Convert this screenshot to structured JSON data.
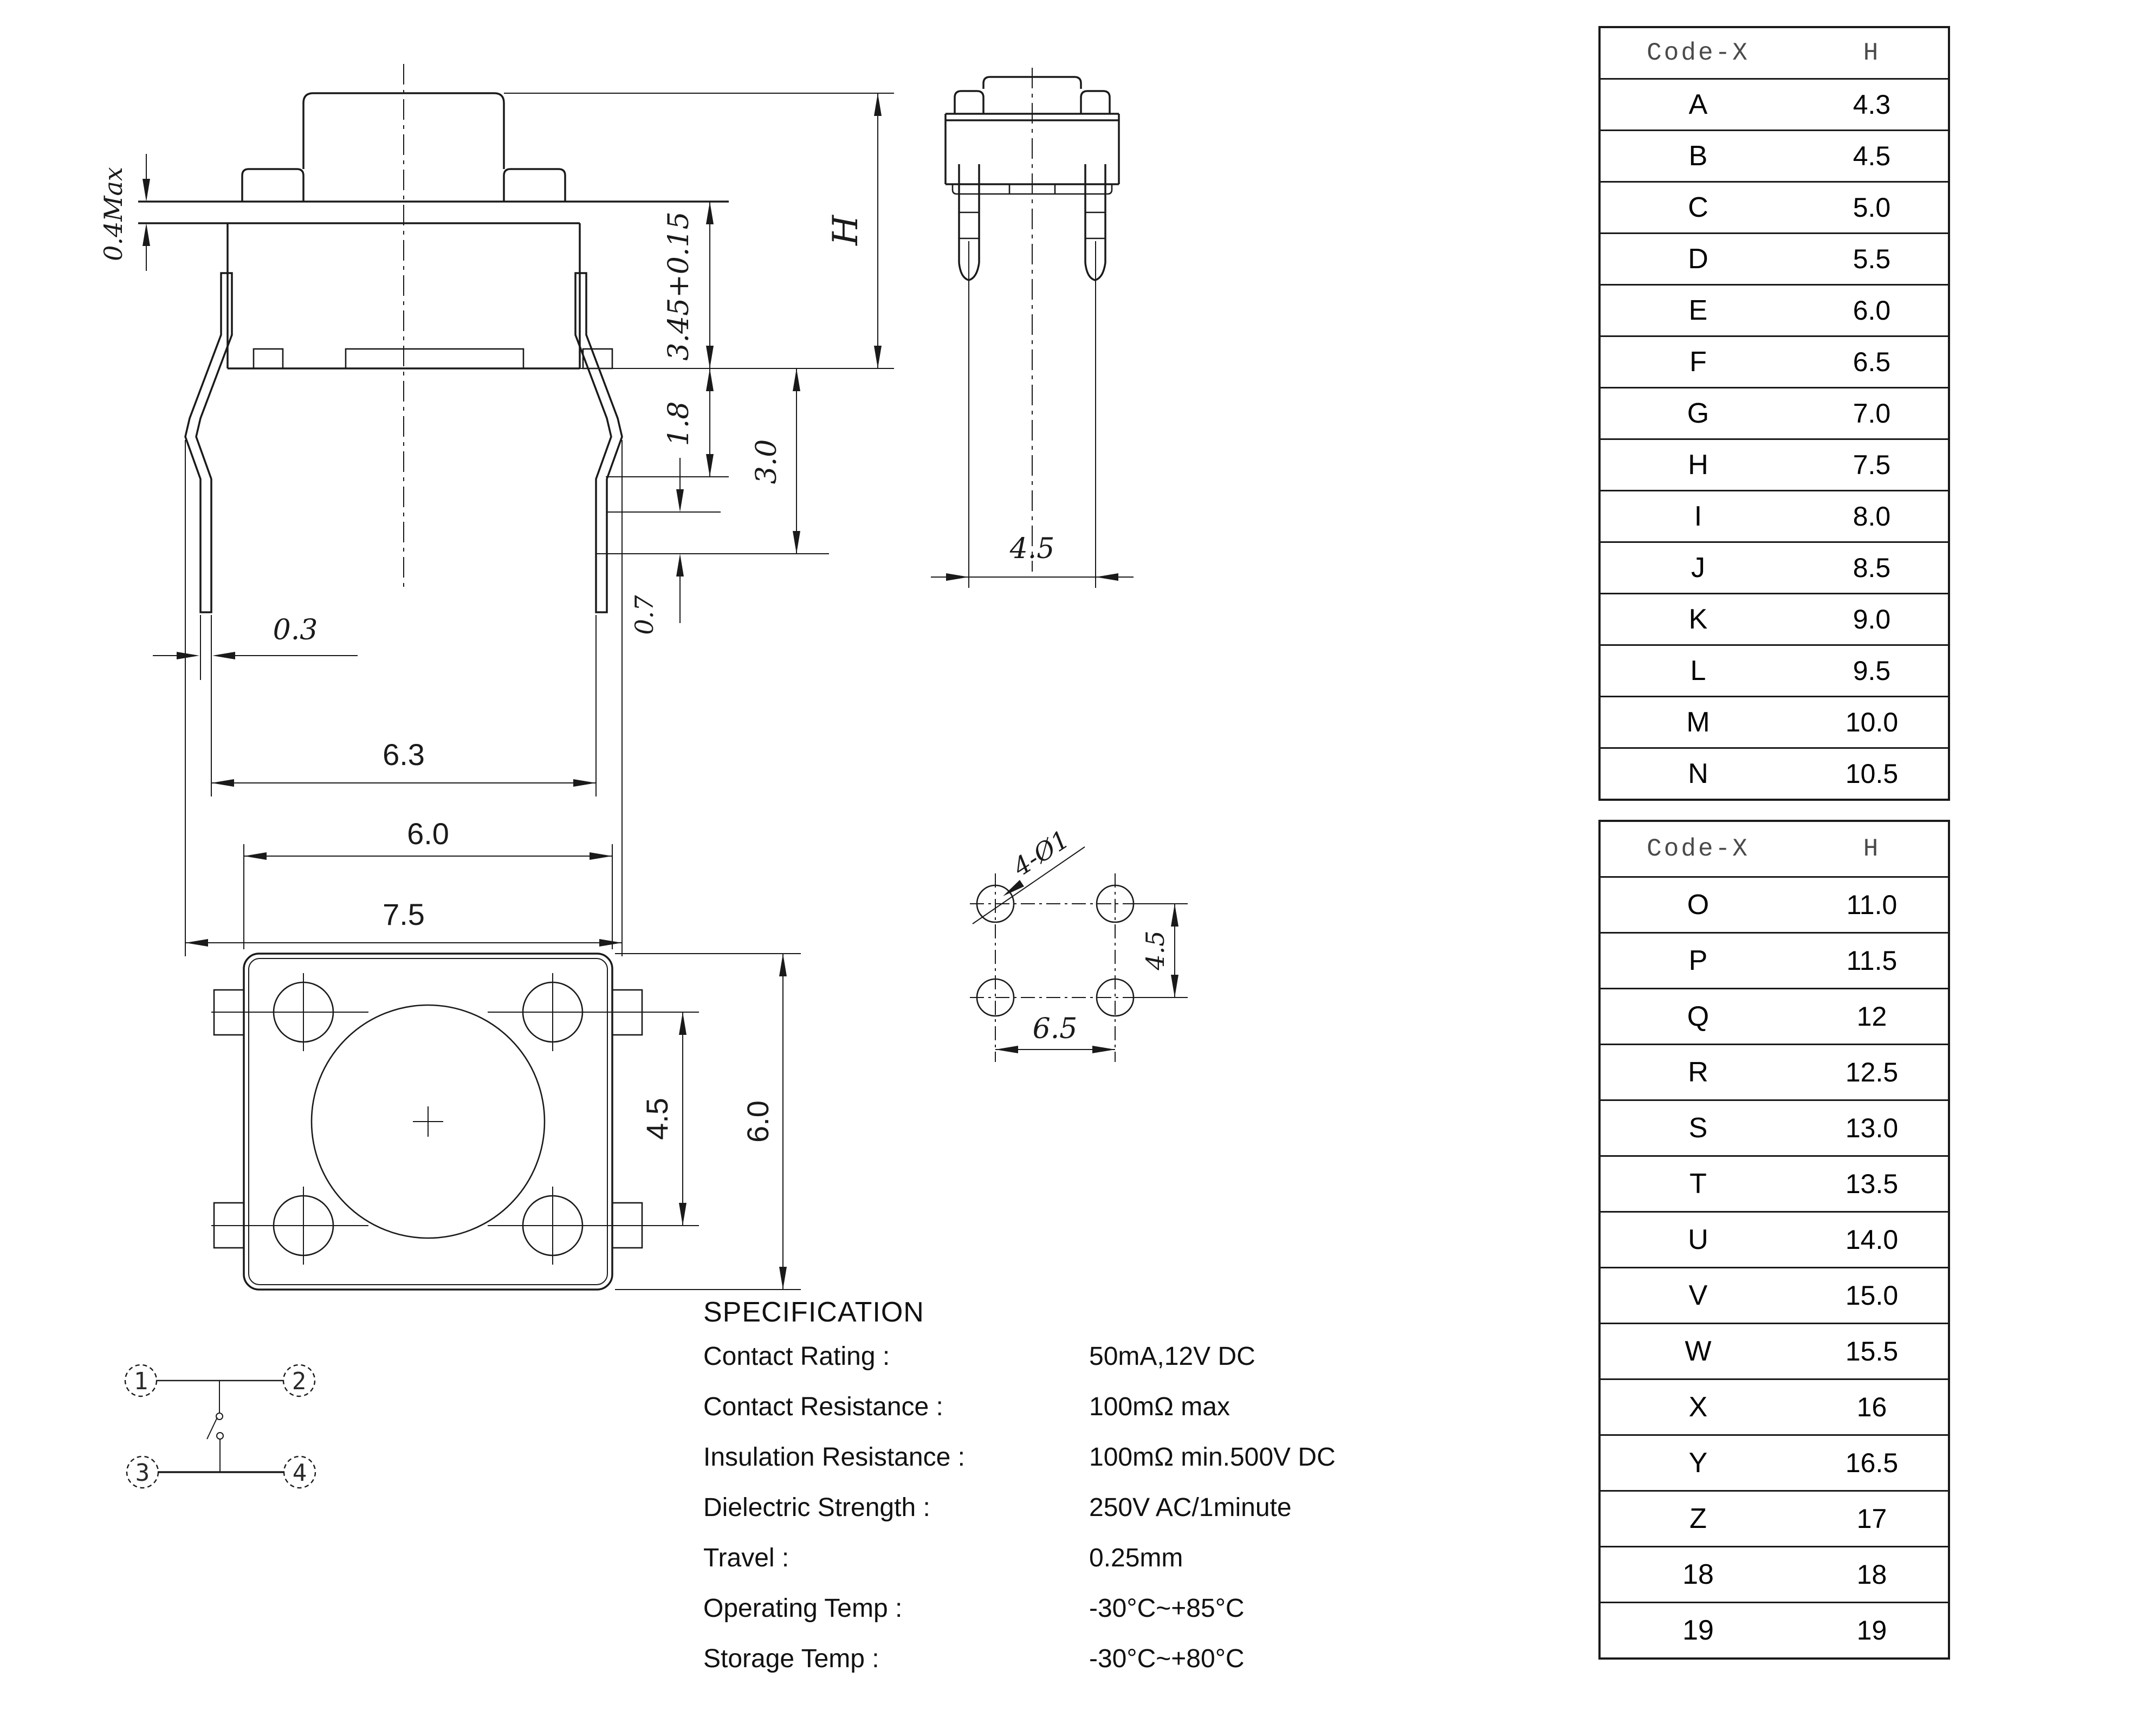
{
  "ink": "#1a1a1a",
  "side_view": {
    "d_cap": "0.4Max",
    "d_body": "3.45+0.15",
    "d_total": "H",
    "d_base": "1.8",
    "d_standoff": "3.0",
    "d_tip": "0.3",
    "d_span_inner": "6.3",
    "d_span_outer": "7.5",
    "d_step": "0.7"
  },
  "front_view": {
    "pin_spacing": "4.5"
  },
  "top_view": {
    "width": "6.0",
    "hole_spacing": "4.5",
    "height": "6.0"
  },
  "pcb_view": {
    "holes_label": "4-Ø1",
    "vertical_pitch": "4.5",
    "horizontal_pitch": "6.5"
  },
  "schematic": {
    "pin1": "1",
    "pin2": "2",
    "pin3": "3",
    "pin4": "4"
  },
  "specification": {
    "title": "SPECIFICATION",
    "items": [
      {
        "label": "Contact  Rating :",
        "value": "50mA,12V DC"
      },
      {
        "label": "Contact  Resistance :",
        "value": "100mΩ max"
      },
      {
        "label": "Insulation Resistance :",
        "value": "100mΩ min.500V DC"
      },
      {
        "label": "Dielectric  Strength :",
        "value": "250V AC/1minute"
      },
      {
        "label": "Travel :",
        "value": "0.25mm"
      },
      {
        "label": "Operating Temp :",
        "value": "-30°C~+85°C"
      },
      {
        "label": "Storage Temp :",
        "value": "-30°C~+80°C"
      }
    ]
  },
  "tables": [
    {
      "col1": "Code-X",
      "col2": "H",
      "rows": [
        [
          "A",
          "4.3"
        ],
        [
          "B",
          "4.5"
        ],
        [
          "C",
          "5.0"
        ],
        [
          "D",
          "5.5"
        ],
        [
          "E",
          "6.0"
        ],
        [
          "F",
          "6.5"
        ],
        [
          "G",
          "7.0"
        ],
        [
          "H",
          "7.5"
        ],
        [
          "I",
          "8.0"
        ],
        [
          "J",
          "8.5"
        ],
        [
          "K",
          "9.0"
        ],
        [
          "L",
          "9.5"
        ],
        [
          "M",
          "10.0"
        ],
        [
          "N",
          "10.5"
        ]
      ]
    },
    {
      "col1": "Code-X",
      "col2": "H",
      "rows": [
        [
          "O",
          "11.0"
        ],
        [
          "P",
          "11.5"
        ],
        [
          "Q",
          "12"
        ],
        [
          "R",
          "12.5"
        ],
        [
          "S",
          "13.0"
        ],
        [
          "T",
          "13.5"
        ],
        [
          "U",
          "14.0"
        ],
        [
          "V",
          "15.0"
        ],
        [
          "W",
          "15.5"
        ],
        [
          "X",
          "16"
        ],
        [
          "Y",
          "16.5"
        ],
        [
          "Z",
          "17"
        ],
        [
          "18",
          "18"
        ],
        [
          "19",
          "19"
        ]
      ]
    }
  ]
}
